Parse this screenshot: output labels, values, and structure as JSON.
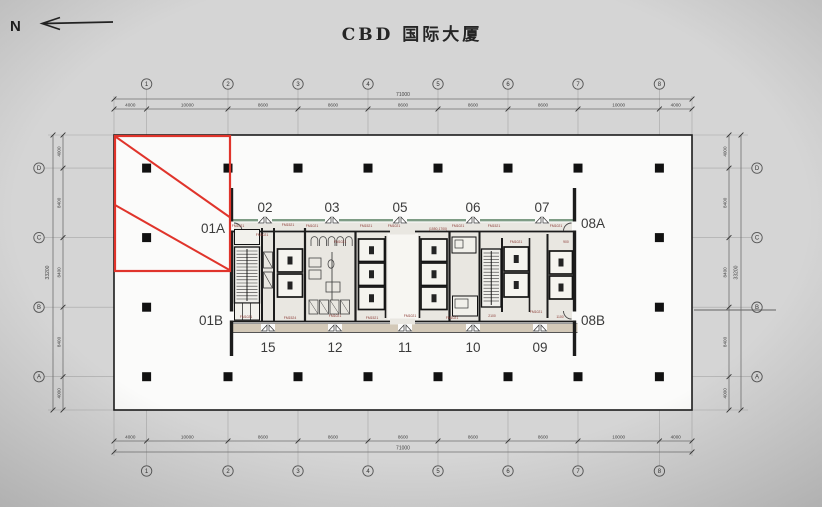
{
  "title": "CBD 国际大厦",
  "north_label": "N",
  "colors": {
    "bg": "#d5d5d5",
    "floor": "#fbfbfa",
    "wall": "#1c1c1c",
    "dim_line": "#6f6f6f",
    "faint_line": "#a6a6a6",
    "highlight_red": "#e0342b",
    "core_green_band": "#7e9c85",
    "core_tan_band": "#d3c9b8",
    "core_fill": "#e9e7e1",
    "door_tag": "#8a3a34",
    "unit_text": "#3b3b3b"
  },
  "axis": {
    "top": {
      "bubbles": [
        "1",
        "2",
        "3",
        "4",
        "5",
        "6",
        "7",
        "8"
      ],
      "segments": [
        "4000",
        "10000",
        "8600",
        "8600",
        "8600",
        "8600",
        "8600",
        "10000",
        "4000"
      ],
      "total": "71000"
    },
    "bottom": {
      "bubbles": [
        "1",
        "2",
        "3",
        "4",
        "5",
        "6",
        "7",
        "8"
      ],
      "segments": [
        "4000",
        "10000",
        "8600",
        "8600",
        "8600",
        "8600",
        "8600",
        "10000",
        "4000"
      ],
      "total": "71000"
    },
    "left": {
      "bubbles": [
        "D",
        "C",
        "B",
        "A"
      ],
      "segments": [
        "4000",
        "8400",
        "8400",
        "8400",
        "4000"
      ],
      "total": "33200"
    },
    "right": {
      "bubbles": [
        "D",
        "C",
        "B",
        "A"
      ],
      "segments": [
        "4000",
        "8400",
        "8400",
        "8400",
        "4000"
      ],
      "total": "33200"
    }
  },
  "units": {
    "top": [
      {
        "label": "02",
        "x": 265
      },
      {
        "label": "03",
        "x": 332
      },
      {
        "label": "05",
        "x": 400
      },
      {
        "label": "06",
        "x": 473
      },
      {
        "label": "07",
        "x": 542
      }
    ],
    "bottom": [
      {
        "label": "15",
        "x": 268
      },
      {
        "label": "12",
        "x": 335
      },
      {
        "label": "11",
        "x": 405
      },
      {
        "label": "10",
        "x": 473
      },
      {
        "label": "09",
        "x": 540
      }
    ],
    "side": [
      {
        "label": "01A",
        "x": 213,
        "y": 233
      },
      {
        "label": "01B",
        "x": 211,
        "y": 325
      },
      {
        "label": "08A",
        "x": 593,
        "y": 228
      },
      {
        "label": "08B",
        "x": 593,
        "y": 325
      }
    ]
  },
  "highlight": {
    "unit": "01A"
  },
  "door_tags": [
    {
      "t": "FM1021",
      "x": 238,
      "y": 227
    },
    {
      "t": "FM1021",
      "x": 262,
      "y": 236
    },
    {
      "t": "FM1521",
      "x": 288,
      "y": 226
    },
    {
      "t": "FM1021",
      "x": 312,
      "y": 227
    },
    {
      "t": "FM1021",
      "x": 340,
      "y": 243
    },
    {
      "t": "FM1521",
      "x": 366,
      "y": 227
    },
    {
      "t": "FM1021",
      "x": 394,
      "y": 227
    },
    {
      "t": "(1550,1700)",
      "x": 438,
      "y": 230
    },
    {
      "t": "FM1021",
      "x": 458,
      "y": 227
    },
    {
      "t": "FM1521",
      "x": 494,
      "y": 227
    },
    {
      "t": "FM1021",
      "x": 516,
      "y": 243
    },
    {
      "t": "FM1021",
      "x": 556,
      "y": 227
    },
    {
      "t": "900",
      "x": 566,
      "y": 243
    },
    {
      "t": "FM1021",
      "x": 246,
      "y": 318
    },
    {
      "t": "FM1524",
      "x": 290,
      "y": 319
    },
    {
      "t": "FM1021",
      "x": 335,
      "y": 317
    },
    {
      "t": "FM1521",
      "x": 372,
      "y": 319
    },
    {
      "t": "FM1021",
      "x": 410,
      "y": 317
    },
    {
      "t": "FM1021",
      "x": 452,
      "y": 319
    },
    {
      "t": "2100",
      "x": 492,
      "y": 317
    },
    {
      "t": "FM1021",
      "x": 536,
      "y": 313
    },
    {
      "t": "1100",
      "x": 560,
      "y": 318
    }
  ]
}
